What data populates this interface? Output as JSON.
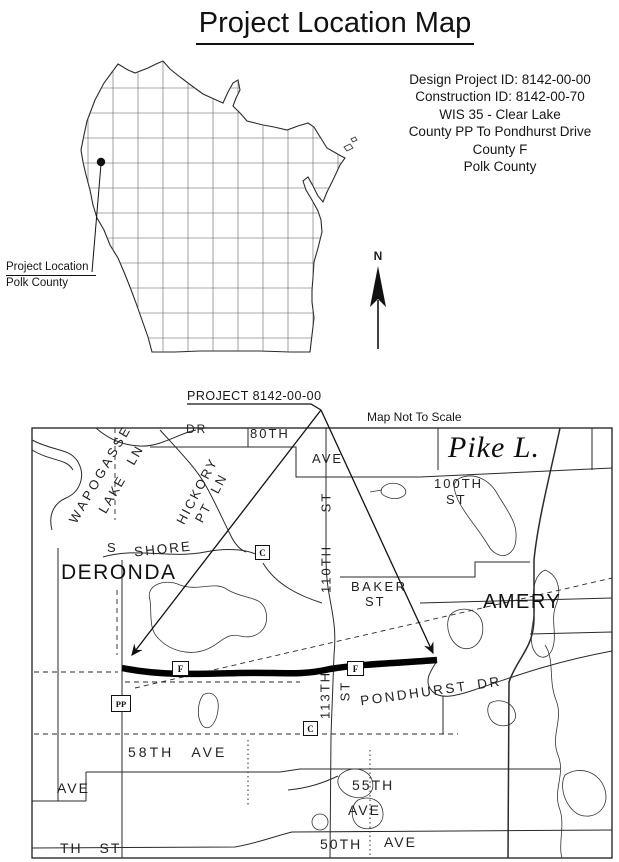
{
  "page": {
    "title": "Project Location Map",
    "ink_color": "#1c1c1c",
    "background_color": "#ffffff"
  },
  "project_info": {
    "lines": [
      "Design Project ID: 8142-00-00",
      "Construction ID: 8142-00-70",
      "WIS 35 - Clear Lake",
      "County PP To Pondhurst Drive",
      "County F",
      "Polk County"
    ]
  },
  "state_map": {
    "callout_title": "Project Location",
    "callout_subtitle": "Polk County"
  },
  "compass": {
    "north_label": "N"
  },
  "detail_map": {
    "callout_label": "PROJECT 8142-00-00",
    "scale_note": "Map Not To Scale",
    "towns": {
      "deronda": "DERONDA",
      "amery": "AMERY"
    },
    "water": {
      "pike_lake": "Pike L."
    },
    "streets": {
      "dr_top": "DR",
      "eightieth": "80TH",
      "eightieth_ave": "AVE",
      "hundredth": "100TH",
      "hundredth_st": "ST",
      "wapogasse": "WAPOGASSE",
      "lake_ln": "LAKE LN",
      "hickory": "HICKORY",
      "pt_ln": "PT LN",
      "shore_s": "S",
      "shore": "SHORE",
      "st_110": "110TH",
      "st_110_st": "ST",
      "baker": "BAKER",
      "baker_st": "ST",
      "pondhurst": "PONDHURST DR",
      "st_113": "113TH",
      "st_113_st": "ST",
      "ave_58": "58TH AVE",
      "ave_left": "AVE",
      "ave_55": "55TH",
      "ave_55_b": "AVE",
      "ave_50": "50TH",
      "ave_50_b": "AVE",
      "th_st_bottom": "TH ST"
    },
    "markers": {
      "county_c": "C",
      "county_f": "F",
      "county_pp": "PP"
    }
  }
}
